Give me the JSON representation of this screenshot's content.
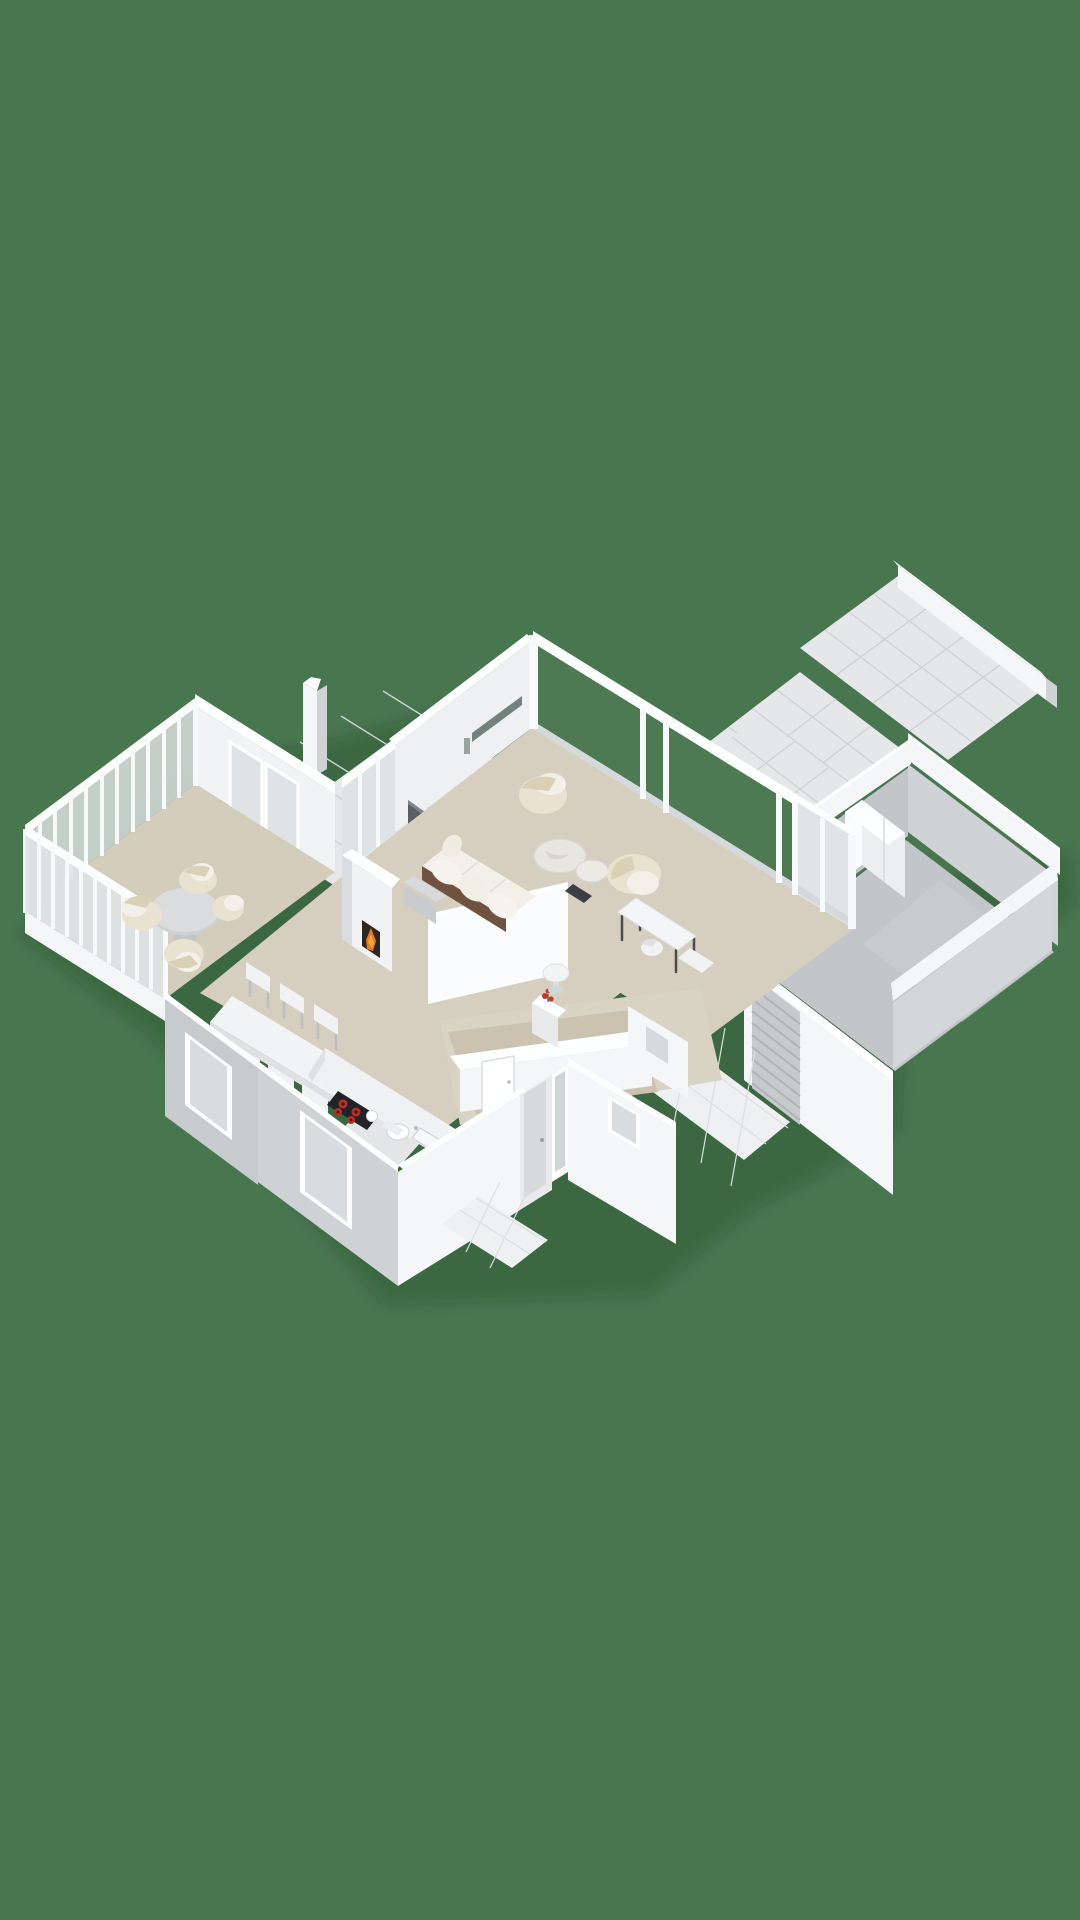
{
  "scene": {
    "type": "isometric-3d-floorplan-render",
    "view": "ground-floor-birds-eye",
    "style": "white-model-with-furnished-rooms"
  },
  "colors": {
    "background": "#48764f",
    "shadow": "rgba(18,38,24,0.18)",
    "floor_main": "#d6cfbf",
    "floor_conservatory": "#d4cdbb",
    "floor_hall": "#d9d3c4",
    "hall_carpet": "#cbc2b0",
    "floor_toilet": "#e3e5e6",
    "floor_garage": "#c3c6c8",
    "tile_light": "#e5e7e9",
    "path_tile": "#eef0f1",
    "wall_white": "#f4f6f7",
    "wall_gray": "#cfd3d6",
    "glass_green": "#4d7a53",
    "slit_window": "#72837c",
    "wood_sofa_base": "#6f5340",
    "cream_fabric": "#e9e2cf",
    "marble_table": "#e8e6e1",
    "fire_flame": "#e67a22",
    "fire_core": "#f3a63d",
    "firebox": "#2e2420",
    "cooktop": "#222326",
    "burner_red": "#b33127",
    "flowers_red": "#c0392b",
    "tv_panel": "#596065",
    "roller_door": "#c7cacc"
  },
  "rooms": [
    {
      "name": "conservatory",
      "floor": "beige",
      "features": [
        "glass-post-walls",
        "round-table",
        "four-wicker-chairs"
      ]
    },
    {
      "name": "living-room",
      "floor": "beige",
      "features": [
        "glazed-northeast-wall",
        "slit-window",
        "long-sideboard",
        "fireplace-with-fire",
        "wood-base-sofa",
        "two-round-coffee-tables",
        "armchair",
        "loveseat",
        "desk-with-chair",
        "dark-side-table",
        "tv-panel",
        "firewood-bench"
      ]
    },
    {
      "name": "dining-area",
      "floor": "beige",
      "features": [
        "long-white-table",
        "six-chairs"
      ]
    },
    {
      "name": "kitchen",
      "floor": "beige",
      "features": [
        "corner-counter",
        "induction-hob-four-red-burners",
        "sink"
      ]
    },
    {
      "name": "hallway",
      "floor": "taupe-carpet",
      "features": [
        "round-pedestal-table",
        "flower-niche",
        "interior-door"
      ]
    },
    {
      "name": "toilet",
      "floor": "gray",
      "features": [
        "toilet",
        "hand-basin"
      ]
    },
    {
      "name": "entrance",
      "features": [
        "front-door",
        "sidelight-window",
        "small-window",
        "tiled-path"
      ]
    },
    {
      "name": "garage",
      "floor": "concrete-gray",
      "features": [
        "roller-door",
        "wardrobe-cabinet",
        "tiled-apron"
      ]
    },
    {
      "name": "back-terrace",
      "features": [
        "gray-tiles",
        "chimney-stack"
      ]
    },
    {
      "name": "garden-terrace",
      "features": [
        "gray-tiles",
        "low-garden-wall",
        "walkway-to-garage"
      ]
    }
  ]
}
